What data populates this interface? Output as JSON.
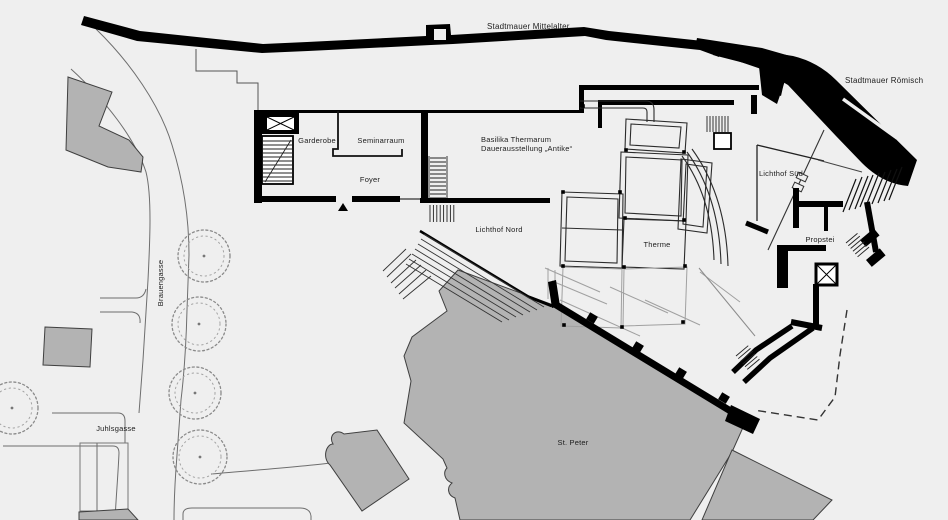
{
  "plan": {
    "labels": {
      "stadtmauer_mittelalter": "Stadtmauer Mittelalter",
      "stadtmauer_roemisch": "Stadtmauer Römisch",
      "garderobe": "Garderobe",
      "seminarraum": "Seminarraum",
      "foyer": "Foyer",
      "basilika_line1": "Basilika Thermarum",
      "basilika_line2": "Dauerausstellung „Antike“",
      "lichthof_nord": "Lichthof Nord",
      "lichthof_sued": "Lichthof Süd",
      "therme": "Therme",
      "propstei": "Propstei",
      "st_peter": "St. Peter",
      "brauengasse": "Brauengasse",
      "juhlsgasse": "Juhlsgasse"
    },
    "colors": {
      "background": "#efefef",
      "wall_black": "#000000",
      "building_gray": "#b3b3b3",
      "thin_line": "#555555"
    }
  }
}
